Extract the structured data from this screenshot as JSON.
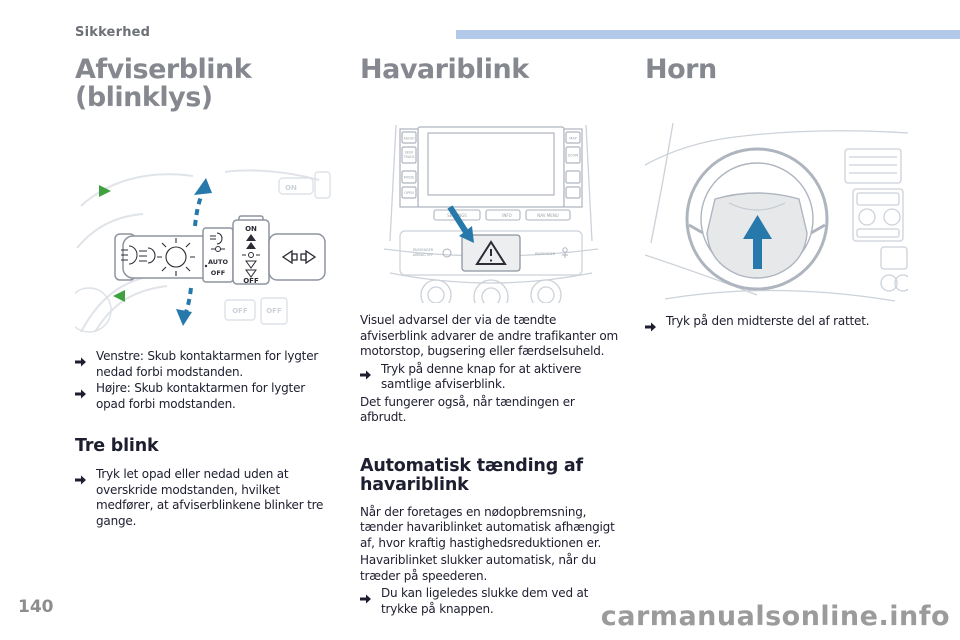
{
  "header": {
    "section": "Sikkerhed"
  },
  "columns": {
    "indicators": {
      "title": "Afviserblink (blinklys)",
      "bullets": [
        "Venstre: Skub kontaktarmen for lygter nedad forbi modstanden.",
        "Højre: Skub kontaktarmen for lygter opad forbi modstanden."
      ],
      "subheading": "Tre blink",
      "subbullet": "Tryk let opad eller nedad uden at overskride modstanden, hvilket medfører, at afviserblinkene blinker tre gange.",
      "figure_labels": {
        "on": "ON",
        "auto": "AUTO",
        "off": "OFF",
        "off2": "OFF",
        "ghost_on": "ON",
        "ghost_off_a": "OFF",
        "ghost_off_b": "OFF"
      }
    },
    "hazard": {
      "title": "Havariblink",
      "intro": "Visuel advarsel der via de tændte afviserblink advarer de andre trafikanter om motorstop, bugsering eller færdselsuheld.",
      "bullet": "Tryk på denne knap for at aktivere samtlige afviserblink.",
      "note": "Det fungerer også, når tændingen er afbrudt.",
      "subheading": "Automatisk tænding af havariblink",
      "para1": "Når der foretages en nødopbremsning, tænder havariblinket automatisk afhængigt af, hvor kraftig hastighedsreduktionen er.",
      "para2": "Havariblinket slukker automatisk, når du træder på speederen.",
      "subbullet": "Du kan ligeledes slukke dem ved at trykke på knappen.",
      "figure_labels": {
        "audio": "AUDIO",
        "seek": "SEEK",
        "track": "TRACK",
        "mode": "MODE",
        "open": "OPEN",
        "map": "MAP",
        "zoom": "ZOOM",
        "settings": "SETTINGS",
        "info": "INFO",
        "nav_menu": "NAV MENU",
        "passenger_l1": "PASSENGER",
        "passenger_l2": "AIRBAG OFF",
        "passenger_r": "PASSENGER"
      }
    },
    "horn": {
      "title": "Horn",
      "bullet": "Tryk på den midterste del af rattet."
    }
  },
  "footer": {
    "page_number": "140",
    "watermark": "carmanualsonline.info"
  },
  "colors": {
    "accent_bar": "#b3c9e9",
    "arrow_blue": "#2779ab",
    "arrow_green": "#3fa040"
  }
}
